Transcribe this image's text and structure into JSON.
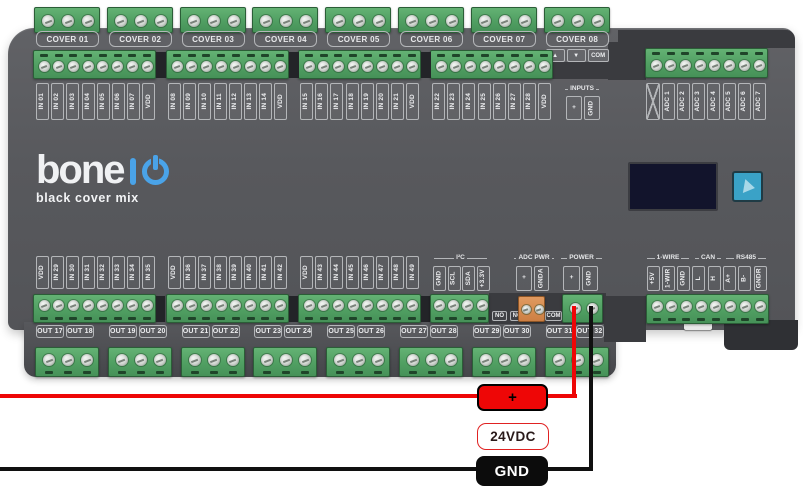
{
  "board": {
    "logo": {
      "brand_main": "bone",
      "brand_io": "IO",
      "subtitle": "black cover mix"
    },
    "covers": [
      "COVER 01",
      "COVER 02",
      "COVER 03",
      "COVER 04",
      "COVER 05",
      "COVER 06",
      "COVER 07",
      "COVER 08"
    ],
    "cover08_pins": [
      "▲",
      "▼",
      "COM"
    ],
    "inputs_top_groups": [
      [
        "IN 01",
        "IN 02",
        "IN 03",
        "IN 04",
        "IN 05",
        "IN 06",
        "IN 07",
        "VDD"
      ],
      [
        "IN 08",
        "IN 09",
        "IN 10",
        "IN 11",
        "IN 12",
        "IN 13",
        "IN 14",
        "VDD"
      ],
      [
        "IN 15",
        "IN 16",
        "IN 17",
        "IN 18",
        "IN 19",
        "IN 20",
        "IN 21",
        "VDD"
      ],
      [
        "IN 22",
        "IN 23",
        "IN 24",
        "IN 25",
        "IN 26",
        "IN 27",
        "IN 28",
        "VDD"
      ]
    ],
    "inputs_header_box": {
      "header": "INPUTS",
      "pins": [
        "+",
        "GND"
      ]
    },
    "adc_inputs": [
      "ADC 1",
      "ADC 2",
      "ADC 3",
      "ADC 4",
      "ADC 5",
      "ADC 6",
      "ADC 7"
    ],
    "inputs_bottom_groups": [
      [
        "VDD",
        "IN 29",
        "IN 30",
        "IN 31",
        "IN 32",
        "IN 33",
        "IN 34",
        "IN 35"
      ],
      [
        "VDD",
        "IN 36",
        "IN 37",
        "IN 38",
        "IN 39",
        "IN 40",
        "IN 41",
        "IN 42"
      ],
      [
        "VDD",
        "IN 43",
        "IN 44",
        "IN 45",
        "IN 46",
        "IN 47",
        "IN 48",
        "IN 49"
      ]
    ],
    "i2c": {
      "header": "I²C",
      "pins": [
        "GND",
        "SCL",
        "SDA",
        "+3.3V"
      ]
    },
    "adc_pwr": {
      "header": "ADC PWR",
      "pins": [
        "+",
        "GNDA"
      ]
    },
    "power": {
      "header": "POWER",
      "pins": [
        "+",
        "GND"
      ]
    },
    "comm": [
      {
        "header": "1-WIRE",
        "pins": [
          "+5V",
          "1-WIR",
          "GND"
        ]
      },
      {
        "header": "CAN",
        "pins": [
          "L",
          "H"
        ]
      },
      {
        "header": "RS485",
        "pins": [
          "A+",
          "B-",
          "GNDR"
        ]
      }
    ],
    "relay_marks": [
      "NO",
      "NC",
      "COM"
    ],
    "outputs": [
      "OUT 17",
      "OUT 18",
      "OUT 19",
      "OUT 20",
      "OUT 21",
      "OUT 22",
      "OUT 23",
      "OUT 24",
      "OUT 25",
      "OUT 26",
      "OUT 27",
      "OUT 28",
      "OUT 29",
      "OUT 30",
      "OUT 31",
      "OUT 32"
    ]
  },
  "wiring": {
    "positive_label": "+",
    "voltage_label": "24VDC",
    "ground_label": "GND"
  },
  "colors": {
    "board": "#58595d",
    "terminal_green": "#509f62",
    "terminal_orange": "#cd7f43",
    "wire_positive": "#ee0606",
    "wire_ground": "#101010",
    "logo_accent": "#4aa3e8",
    "button_teal": "#3aa2c7",
    "oled_navy": "#12142c"
  }
}
